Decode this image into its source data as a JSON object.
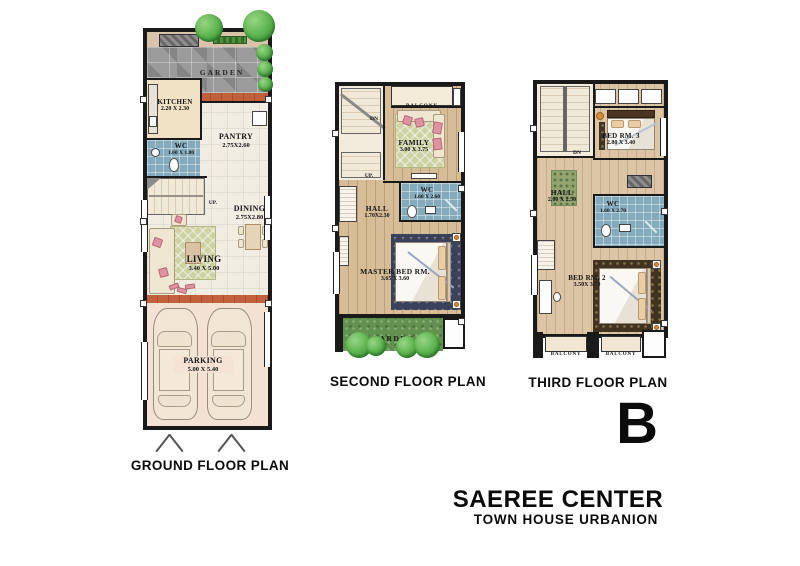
{
  "title_block": {
    "unit_letter": "B",
    "project_name": "SAEREE CENTER",
    "project_subtitle": "TOWN HOUSE URBANION"
  },
  "colors": {
    "wall": "#1a1a1a",
    "tile_floor": "#f2ede3",
    "wood_floor": "#d7bc98",
    "wc_floor": "#84abbc",
    "stone_garden": "#9b9b9b",
    "grass_garden": "#63914f",
    "terracotta_edge": "#c3603c",
    "tree_green": "#58b14b",
    "accent_pink": "#df93a0",
    "navy_bedding": "#3a415a"
  },
  "plans": {
    "ground": {
      "label": "GROUND FLOOR PLAN",
      "garden": {
        "name": "GARDEN"
      },
      "kitchen": {
        "name": "KITCHEN",
        "dims": "2.20 X 2.30"
      },
      "wc": {
        "name": "WC",
        "dims": "1.60 X 1.80"
      },
      "pantry": {
        "name": "PANTRY",
        "dims": "2.75X2.60"
      },
      "dining": {
        "name": "DINING",
        "dims": "2.75X2.80"
      },
      "living": {
        "name": "LIVING",
        "dims": "3.40 X 5.00"
      },
      "parking": {
        "name": "PARKING",
        "dims": "5.00 X 5.40"
      },
      "stair_up": "UP."
    },
    "second": {
      "label": "SECOND FLOOR PLAN",
      "balcony": {
        "name": "BALCONY"
      },
      "family": {
        "name": "FAMILY",
        "dims": "3.00 X 3.75"
      },
      "wc": {
        "name": "WC",
        "dims": "1.60 X 2.60"
      },
      "hall": {
        "name": "HALL",
        "dims": "1.70X2.30"
      },
      "master_bed": {
        "name": "MASTER BED RM.",
        "dims": "3.65 X 3.60"
      },
      "garden": {
        "name": "GARDEN"
      },
      "stair_dn": "DN",
      "stair_up": "UP."
    },
    "third": {
      "label": "THIRD FLOOR PLAN",
      "bed3": {
        "name": "BED RM. 3",
        "dims": "2.80 X 3.40"
      },
      "hall": {
        "name": "HALL",
        "dims": "2.00 X 2.50"
      },
      "wc": {
        "name": "WC",
        "dims": "1.60 X 2.70"
      },
      "bed2": {
        "name": "BED RM. 2",
        "dims": "3.50X 3.60"
      },
      "balcony_left": {
        "name": "BALCONY"
      },
      "balcony_right": {
        "name": "BALCONY"
      },
      "stair_dn": "DN"
    }
  }
}
